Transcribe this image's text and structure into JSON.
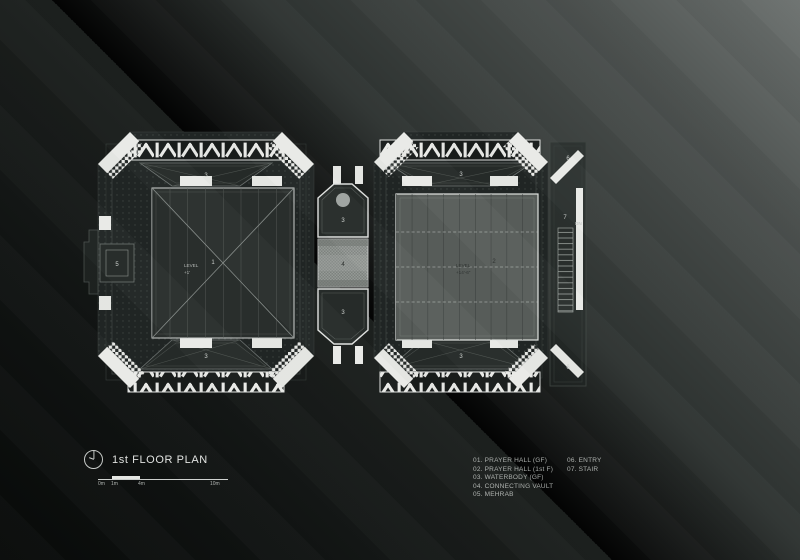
{
  "title_block": {
    "title": "1st FLOOR PLAN"
  },
  "scale_bar": {
    "labels": [
      "0m",
      "1m",
      "4m",
      "10m"
    ]
  },
  "legend": {
    "column1": [
      "01. PRAYER HALL (GF)",
      "02. PRAYER HALL (1st F)",
      "03. WATERBODY (GF)",
      "04. CONNECTING VAULT",
      "05. MEHRAB"
    ],
    "column2": [
      "06. ENTRY",
      "07. STAIR"
    ]
  },
  "plan": {
    "labels": {
      "prayer_hall_gf": "1",
      "prayer_hall_1f": "2",
      "waterbody": "3",
      "connecting_vault": "4",
      "mehrab": "5",
      "entry": "6",
      "stair": "7",
      "down": "DN",
      "level_left_line1": "LEVEL",
      "level_left_line2": "+1'",
      "level_right_line1": "LEVEL",
      "level_right_line2": "+14'-6\""
    },
    "colors": {
      "paper_white": "#e9eae7",
      "hall_dark": "#212625",
      "hall_light_floor": "#595e5b"
    }
  }
}
